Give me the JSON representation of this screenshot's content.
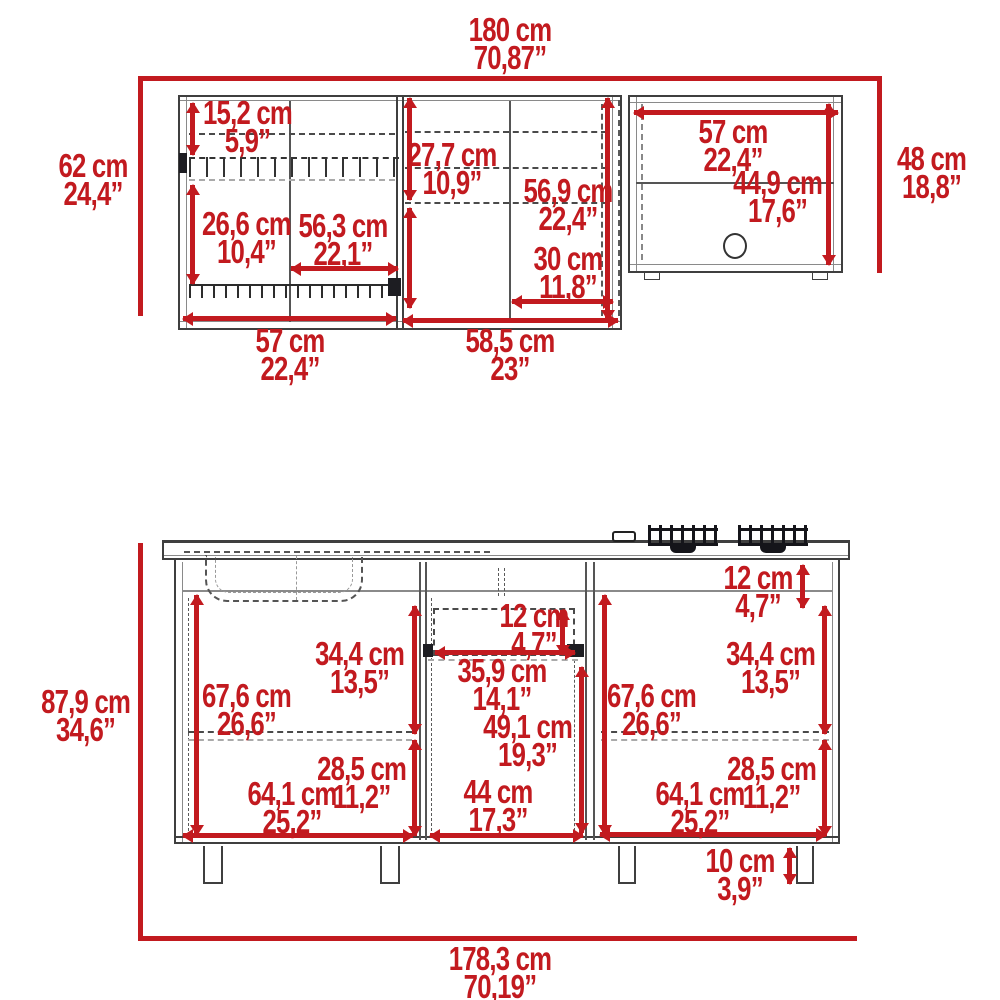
{
  "diagram_title": "kitchen-cabinet-set-dimension-drawing",
  "colors": {
    "dimension_red": "#c21a1f",
    "linework_dark": "#3f3f3f"
  },
  "upper_cabinet": {
    "overall_width": {
      "cm": "180 cm",
      "in": "70,87”"
    },
    "left_height": {
      "cm": "62 cm",
      "in": "24,4”"
    },
    "right_height": {
      "cm": "48 cm",
      "in": "18,8”"
    },
    "top_shelf_spacing": {
      "cm": "15,2 cm",
      "in": "5,9”"
    },
    "bottom_shelf_spacing": {
      "cm": "26,6 cm",
      "in": "10,4”"
    },
    "glass_rack_width": {
      "cm": "56,3 cm",
      "in": "22,1”"
    },
    "middle_upper_shelf_spacing": {
      "cm": "27,7 cm",
      "in": "10,9”"
    },
    "door_interior_height": {
      "cm": "56,9 cm",
      "in": "22,4”"
    },
    "right_shelf_width": {
      "cm": "30 cm",
      "in": "11,8”"
    },
    "open_shelf_width": {
      "cm": "57 cm",
      "in": "22,4”"
    },
    "open_shelf_interior_height": {
      "cm": "44,9 cm",
      "in": "17,6”"
    },
    "left_section_width": {
      "cm": "57 cm",
      "in": "22,4”"
    },
    "right_section_width": {
      "cm": "58,5 cm",
      "in": "23”"
    }
  },
  "base_cabinet": {
    "overall_height": {
      "cm": "87,9 cm",
      "in": "34,6”"
    },
    "overall_width": {
      "cm": "178,3 cm",
      "in": "70,19”"
    },
    "top_rail_height": {
      "cm": "12 cm",
      "in": "4,7”"
    },
    "drawer_height": {
      "cm": "12 cm",
      "in": "4,7”"
    },
    "drawer_width": {
      "cm": "35,9 cm",
      "in": "14,1”"
    },
    "left_interior_height": {
      "cm": "67,6 cm",
      "in": "26,6”"
    },
    "left_upper_section_height": {
      "cm": "34,4 cm",
      "in": "13,5”"
    },
    "left_lower_section_height": {
      "cm": "28,5 cm",
      "in": "11,2”"
    },
    "left_door_width": {
      "cm": "64,1 cm",
      "in": "25,2”"
    },
    "center_door_height": {
      "cm": "49,1 cm",
      "in": "19,3”"
    },
    "center_door_width": {
      "cm": "44 cm",
      "in": "17,3”"
    },
    "right_interior_height": {
      "cm": "67,6 cm",
      "in": "26,6”"
    },
    "right_upper_section_height": {
      "cm": "34,4 cm",
      "in": "13,5”"
    },
    "right_lower_section_height": {
      "cm": "28,5 cm",
      "in": "11,2”"
    },
    "right_door_width": {
      "cm": "64,1 cm",
      "in": "25,2”"
    },
    "leg_height": {
      "cm": "10 cm",
      "in": "3,9”"
    }
  }
}
